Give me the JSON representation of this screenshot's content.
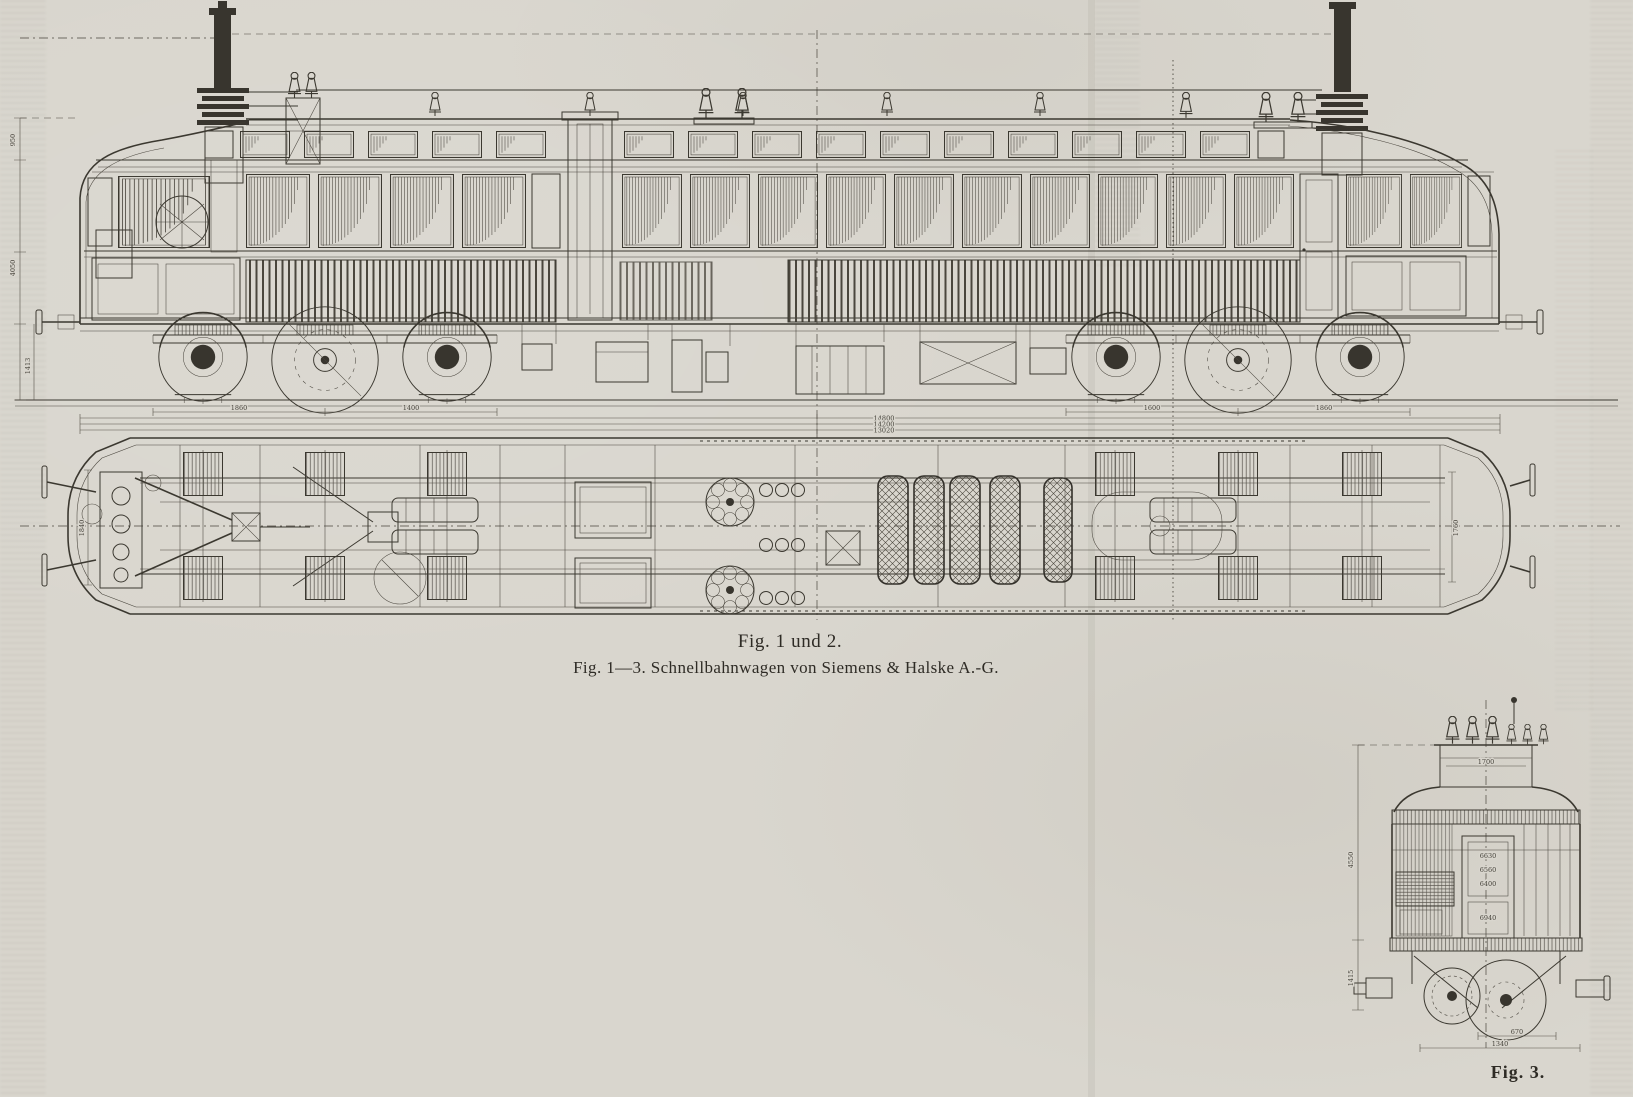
{
  "page": {
    "kind": "scanned engineering drawing plate",
    "paper_color": "#d9d6ce",
    "ink_color": "#3b3830"
  },
  "captions": {
    "fig_1_2": "Fig. 1 und 2.",
    "fig_1_3": "Fig. 1—3.  Schnellbahnwagen von Siemens & Halske A.-G.",
    "fig_3": "Fig. 3."
  },
  "dimensions": {
    "fig1": {
      "overall_a": "14800",
      "overall_b": "14200",
      "overall_c": "13020",
      "height_left_top": "950",
      "height_left_mid": "4050",
      "height_left_low": "1413",
      "bogie_left_a": "1860",
      "bogie_left_b": "1400",
      "bogie_right_a": "1600",
      "bogie_right_b": "1860"
    },
    "fig2": {
      "width_left": "1840",
      "width_right": "1760"
    },
    "fig3": {
      "clerestory_width": "1700",
      "door_a": "6630",
      "door_b": "6560",
      "door_c": "6400",
      "door_d": "6940",
      "height": "4550",
      "lower_height": "1415",
      "bottom_a": "670",
      "bottom_b": "1340"
    }
  }
}
